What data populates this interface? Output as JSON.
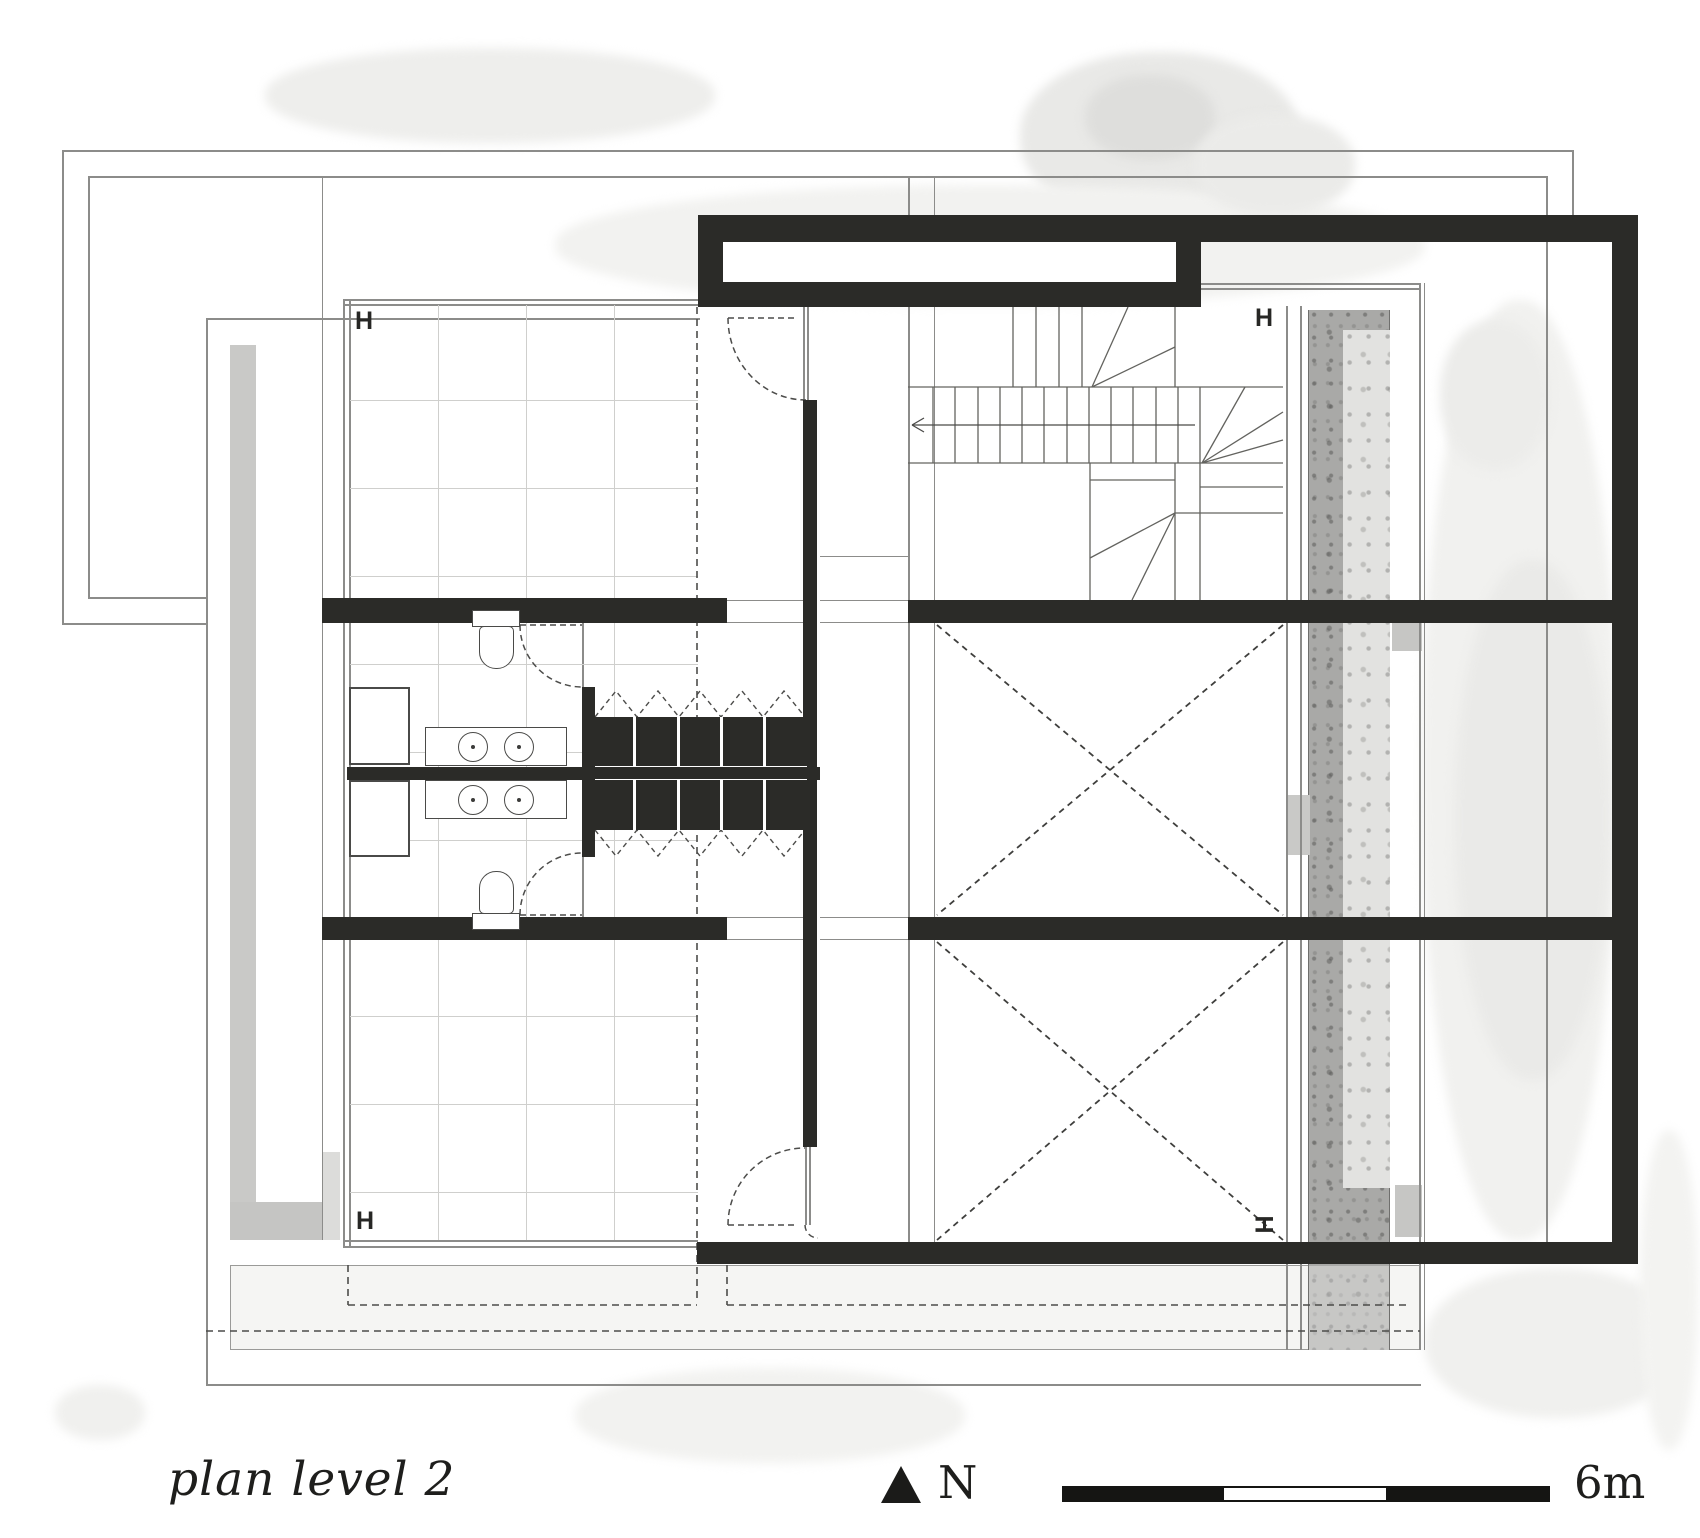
{
  "meta": {
    "kind": "architectural floor plan drawing"
  },
  "annotations": {
    "title": "plan level 2",
    "north_label": "N",
    "scale_label": "6m"
  },
  "column_markers": [
    {
      "glyph": "H"
    },
    {
      "glyph": "H"
    },
    {
      "glyph": "H"
    },
    {
      "glyph": "H"
    }
  ],
  "scale_bar": {
    "segments": 3,
    "length_label": "6m"
  },
  "compass": {
    "icon": "north-arrow-icon",
    "label": "N"
  },
  "colors": {
    "wall": "#2b2b28",
    "thin_line": "#8c8c8a",
    "tile_line": "#cfcfcd",
    "dashed_line": "#4c4c4a",
    "grey_strip": "#c9c9c7",
    "stone_dark": "#a8a8a6",
    "stone_light": "#e2e2e0",
    "terrace_fill": "#f5f5f3",
    "watercolor": "#ececea"
  }
}
